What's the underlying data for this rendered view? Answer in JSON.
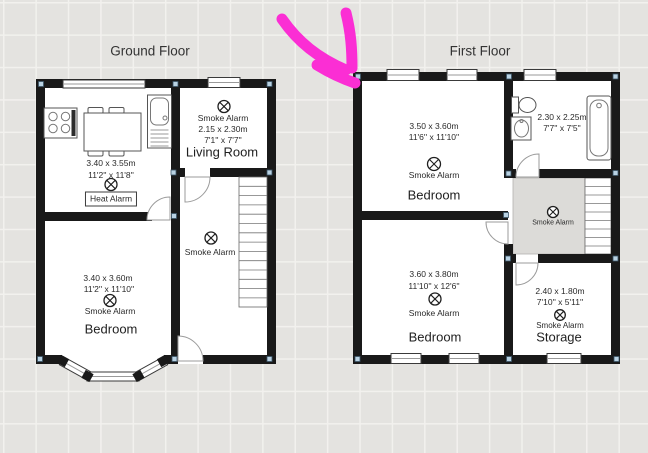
{
  "colors": {
    "wall": "#191919",
    "background": "#e4e3e0",
    "grid_line": "#f2f1ee",
    "room_fill": "#ffffff",
    "landing_fill": "#dcdbd8",
    "corner_dot": "#b9d2e3",
    "annotation_arrow": "#fb2ed4",
    "text": "#2a2a2a"
  },
  "icons": {
    "smoke_alarm": "circle-with-diagonal-cross",
    "heat_alarm": "circle-with-diagonal-cross",
    "annotation": "hand-drawn-arrow"
  },
  "ground_floor": {
    "title": "Ground Floor",
    "kitchen": {
      "dims_m": "3.40 x 3.55m",
      "dims_ft": "11'2'' x 11'8''",
      "alarm_label": "Heat Alarm"
    },
    "living_room": {
      "alarm_label": "Smoke Alarm",
      "dims_m": "2.15 x 2.30m",
      "dims_ft": "7'1'' x 7'7''",
      "name": "Living Room"
    },
    "hallway": {
      "alarm_label": "Smoke Alarm"
    },
    "bedroom": {
      "dims_m": "3.40 x 3.60m",
      "dims_ft": "11'2'' x 11'10''",
      "alarm_label": "Smoke Alarm",
      "name": "Bedroom"
    }
  },
  "first_floor": {
    "title": "First Floor",
    "bedroom_front": {
      "dims_m": "3.50 x 3.60m",
      "dims_ft": "11'6'' x 11'10''",
      "alarm_label": "Smoke Alarm",
      "name": "Bedroom"
    },
    "bathroom": {
      "dims_m": "2.30 x 2.25m",
      "dims_ft": "7'7'' x 7'5''"
    },
    "landing": {
      "alarm_label": "Smoke Alarm"
    },
    "bedroom_back": {
      "dims_m": "3.60 x 3.80m",
      "dims_ft": "11'10'' x 12'6''",
      "alarm_label": "Smoke Alarm",
      "name": "Bedroom"
    },
    "storage": {
      "dims_m": "2.40 x 1.80m",
      "dims_ft": "7'10'' x 5'11''",
      "alarm_label": "Smoke Alarm",
      "name": "Storage"
    }
  }
}
